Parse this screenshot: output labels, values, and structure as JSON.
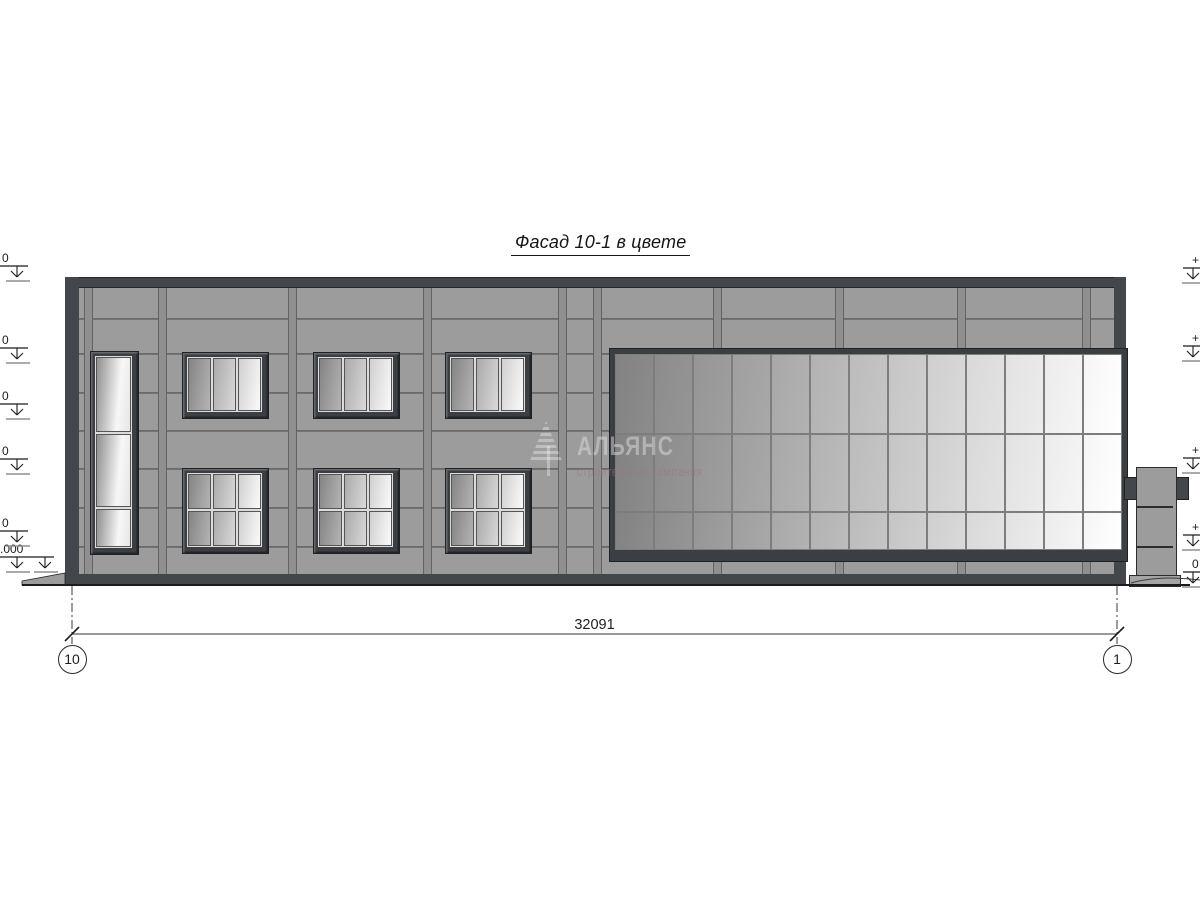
{
  "title": "Фасад 10-1 в цвете",
  "watermark": {
    "name": "АЛЬЯНС",
    "subtitle": "строительная компания"
  },
  "dimension": {
    "total": "32091"
  },
  "grid_axes": [
    {
      "label": "10"
    },
    {
      "label": "1"
    }
  ],
  "elevation_marks": {
    "left": [
      {
        "y": 266,
        "text": "0"
      },
      {
        "y": 348,
        "text": "0"
      },
      {
        "y": 404,
        "text": "0"
      },
      {
        "y": 459,
        "text": "0"
      },
      {
        "y": 531,
        "text": "0"
      },
      {
        "y": 557,
        "text": ".000",
        "double": true
      }
    ],
    "right": [
      {
        "y": 268,
        "text": "+"
      },
      {
        "y": 346,
        "text": "+"
      },
      {
        "y": 458,
        "text": "+"
      },
      {
        "y": 535,
        "text": "+"
      },
      {
        "y": 572,
        "text": "0"
      }
    ]
  },
  "drawing": {
    "colors": {
      "wall": "#9c9c9c",
      "dark": "#43474b",
      "outline": "#1c1c1c",
      "joint": "#6a6a6a",
      "shelf": "#8f8f8f",
      "thin_line": "#333333"
    },
    "building": {
      "x": 65,
      "y": 277,
      "w": 1061,
      "h": 308
    },
    "parapet_h": 11,
    "base_y": 574,
    "edge_left": {
      "x": 65,
      "w": 14
    },
    "edge_right_segments": [
      {
        "x": 1114,
        "w": 12,
        "y1": 277,
        "y2": 353
      },
      {
        "x": 1114,
        "w": 12,
        "y1": 548,
        "y2": 585
      }
    ],
    "h_joints": [
      318,
      353,
      392,
      430,
      468,
      507,
      546
    ],
    "v_joints": [
      84,
      158,
      288,
      423,
      558,
      593,
      713,
      835,
      957,
      1082
    ],
    "tall_window": {
      "x": 90,
      "y": 351,
      "w": 47,
      "h": 202,
      "row_splits": [
        0.4,
        0.79
      ]
    },
    "upper_windows": {
      "xs": [
        182,
        313,
        445
      ],
      "y": 352,
      "w": 85,
      "h": 65,
      "cols": 3,
      "row_splits": []
    },
    "lower_windows": {
      "xs": [
        182,
        313,
        445
      ],
      "y": 468,
      "w": 85,
      "h": 84,
      "cols": 3,
      "row_splits": [
        0.5
      ]
    },
    "curtain_wall": {
      "x": 609,
      "y": 348,
      "w": 517,
      "h": 212,
      "cols": 13,
      "row_splits": [
        0.41,
        0.805
      ],
      "frame": {
        "top": 5,
        "left": 5,
        "right": 3,
        "bottom": 9
      }
    },
    "pillar": {
      "body": {
        "x": 1136,
        "y": 467,
        "w": 39,
        "h": 114
      },
      "divisions": [
        505,
        545
      ],
      "bracket_left": {
        "x": 1124,
        "y": 477,
        "w": 12,
        "h": 21
      },
      "bracket_right": {
        "x": 1175,
        "y": 477,
        "w": 12,
        "h": 21
      },
      "plate": {
        "x": 1129,
        "y": 575,
        "w": 50,
        "h": 10
      }
    },
    "ground": {
      "x1": 22,
      "x2": 1190,
      "y": 585
    },
    "sidewalk_pts": "22,581 65,573 65,585 22,585",
    "plate_curve": "M 1131,583 C 1152,577 1172,577 1200,580",
    "dimension_line": {
      "x1": 72,
      "x2": 1117,
      "y": 634,
      "label_y": 617
    },
    "grid": [
      {
        "x": 72
      },
      {
        "x": 1117
      }
    ],
    "grid_line": {
      "y1": 586,
      "y2": 644
    },
    "bubble_cy": 659,
    "bubble_r": 14.5
  }
}
